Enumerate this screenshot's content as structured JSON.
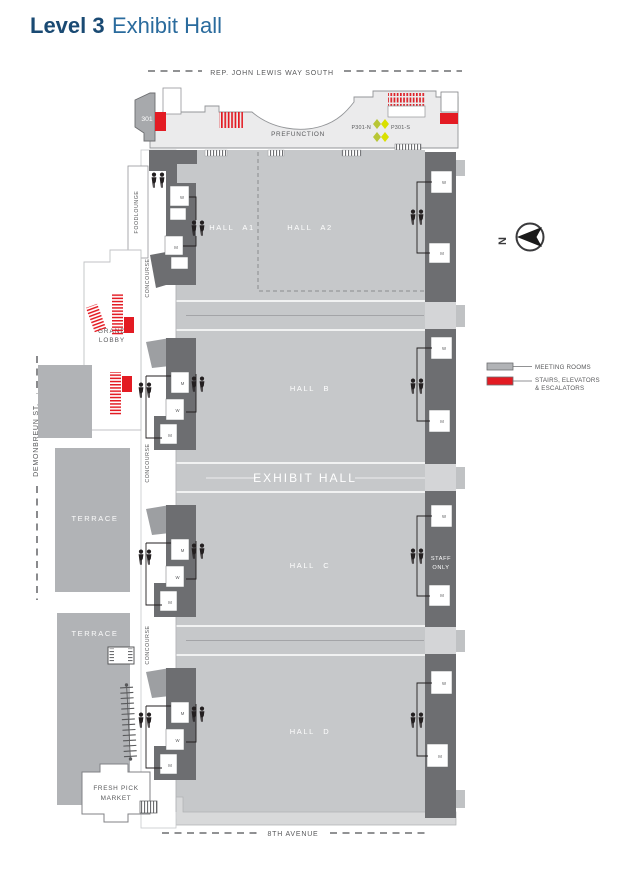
{
  "title": {
    "level": "Level 3",
    "name": "Exhibit Hall"
  },
  "streets": {
    "top": "REP. JOHN LEWIS WAY SOUTH",
    "bottom": "8TH AVENUE",
    "left": "DEMONBREUN ST."
  },
  "compass": {
    "north": "N"
  },
  "legend": {
    "meeting_rooms": {
      "label": "MEETING ROOMS",
      "color": "#b1b3b6"
    },
    "stairs": {
      "label_line1": "STAIRS, ELEVATORS",
      "label_line2": "& ESCALATORS",
      "color": "#e31b23"
    }
  },
  "halls": {
    "a1": "HALL A1",
    "a2": "HALL A2",
    "b": "HALL B",
    "c": "HALL C",
    "d": "HALL D",
    "exhibit": "EXHIBIT HALL"
  },
  "areas": {
    "prefunction": "PREFUNCTION",
    "room301": "301",
    "p301n": "P301-N",
    "p301s": "P301-S",
    "foodlounge": "FOODLOUNGE",
    "grand_lobby_line1": "GRAND",
    "grand_lobby_line2": "LOBBY",
    "concourse": "CONCOURSE",
    "terrace": "TERRACE",
    "staff_line1": "STAFF",
    "staff_line2": "ONLY",
    "market_line1": "FRESH PICK",
    "market_line2": "MARKET"
  },
  "restrooms": {
    "men": "M",
    "women": "W"
  },
  "colors": {
    "hall_gray": "#c6c8ca",
    "service_gray": "#6d6e71",
    "terrace_gray": "#b1b3b6",
    "stairs_red": "#e31b23",
    "elevator_yellow": "#d7df23",
    "title_blue": "#1a4a73"
  }
}
